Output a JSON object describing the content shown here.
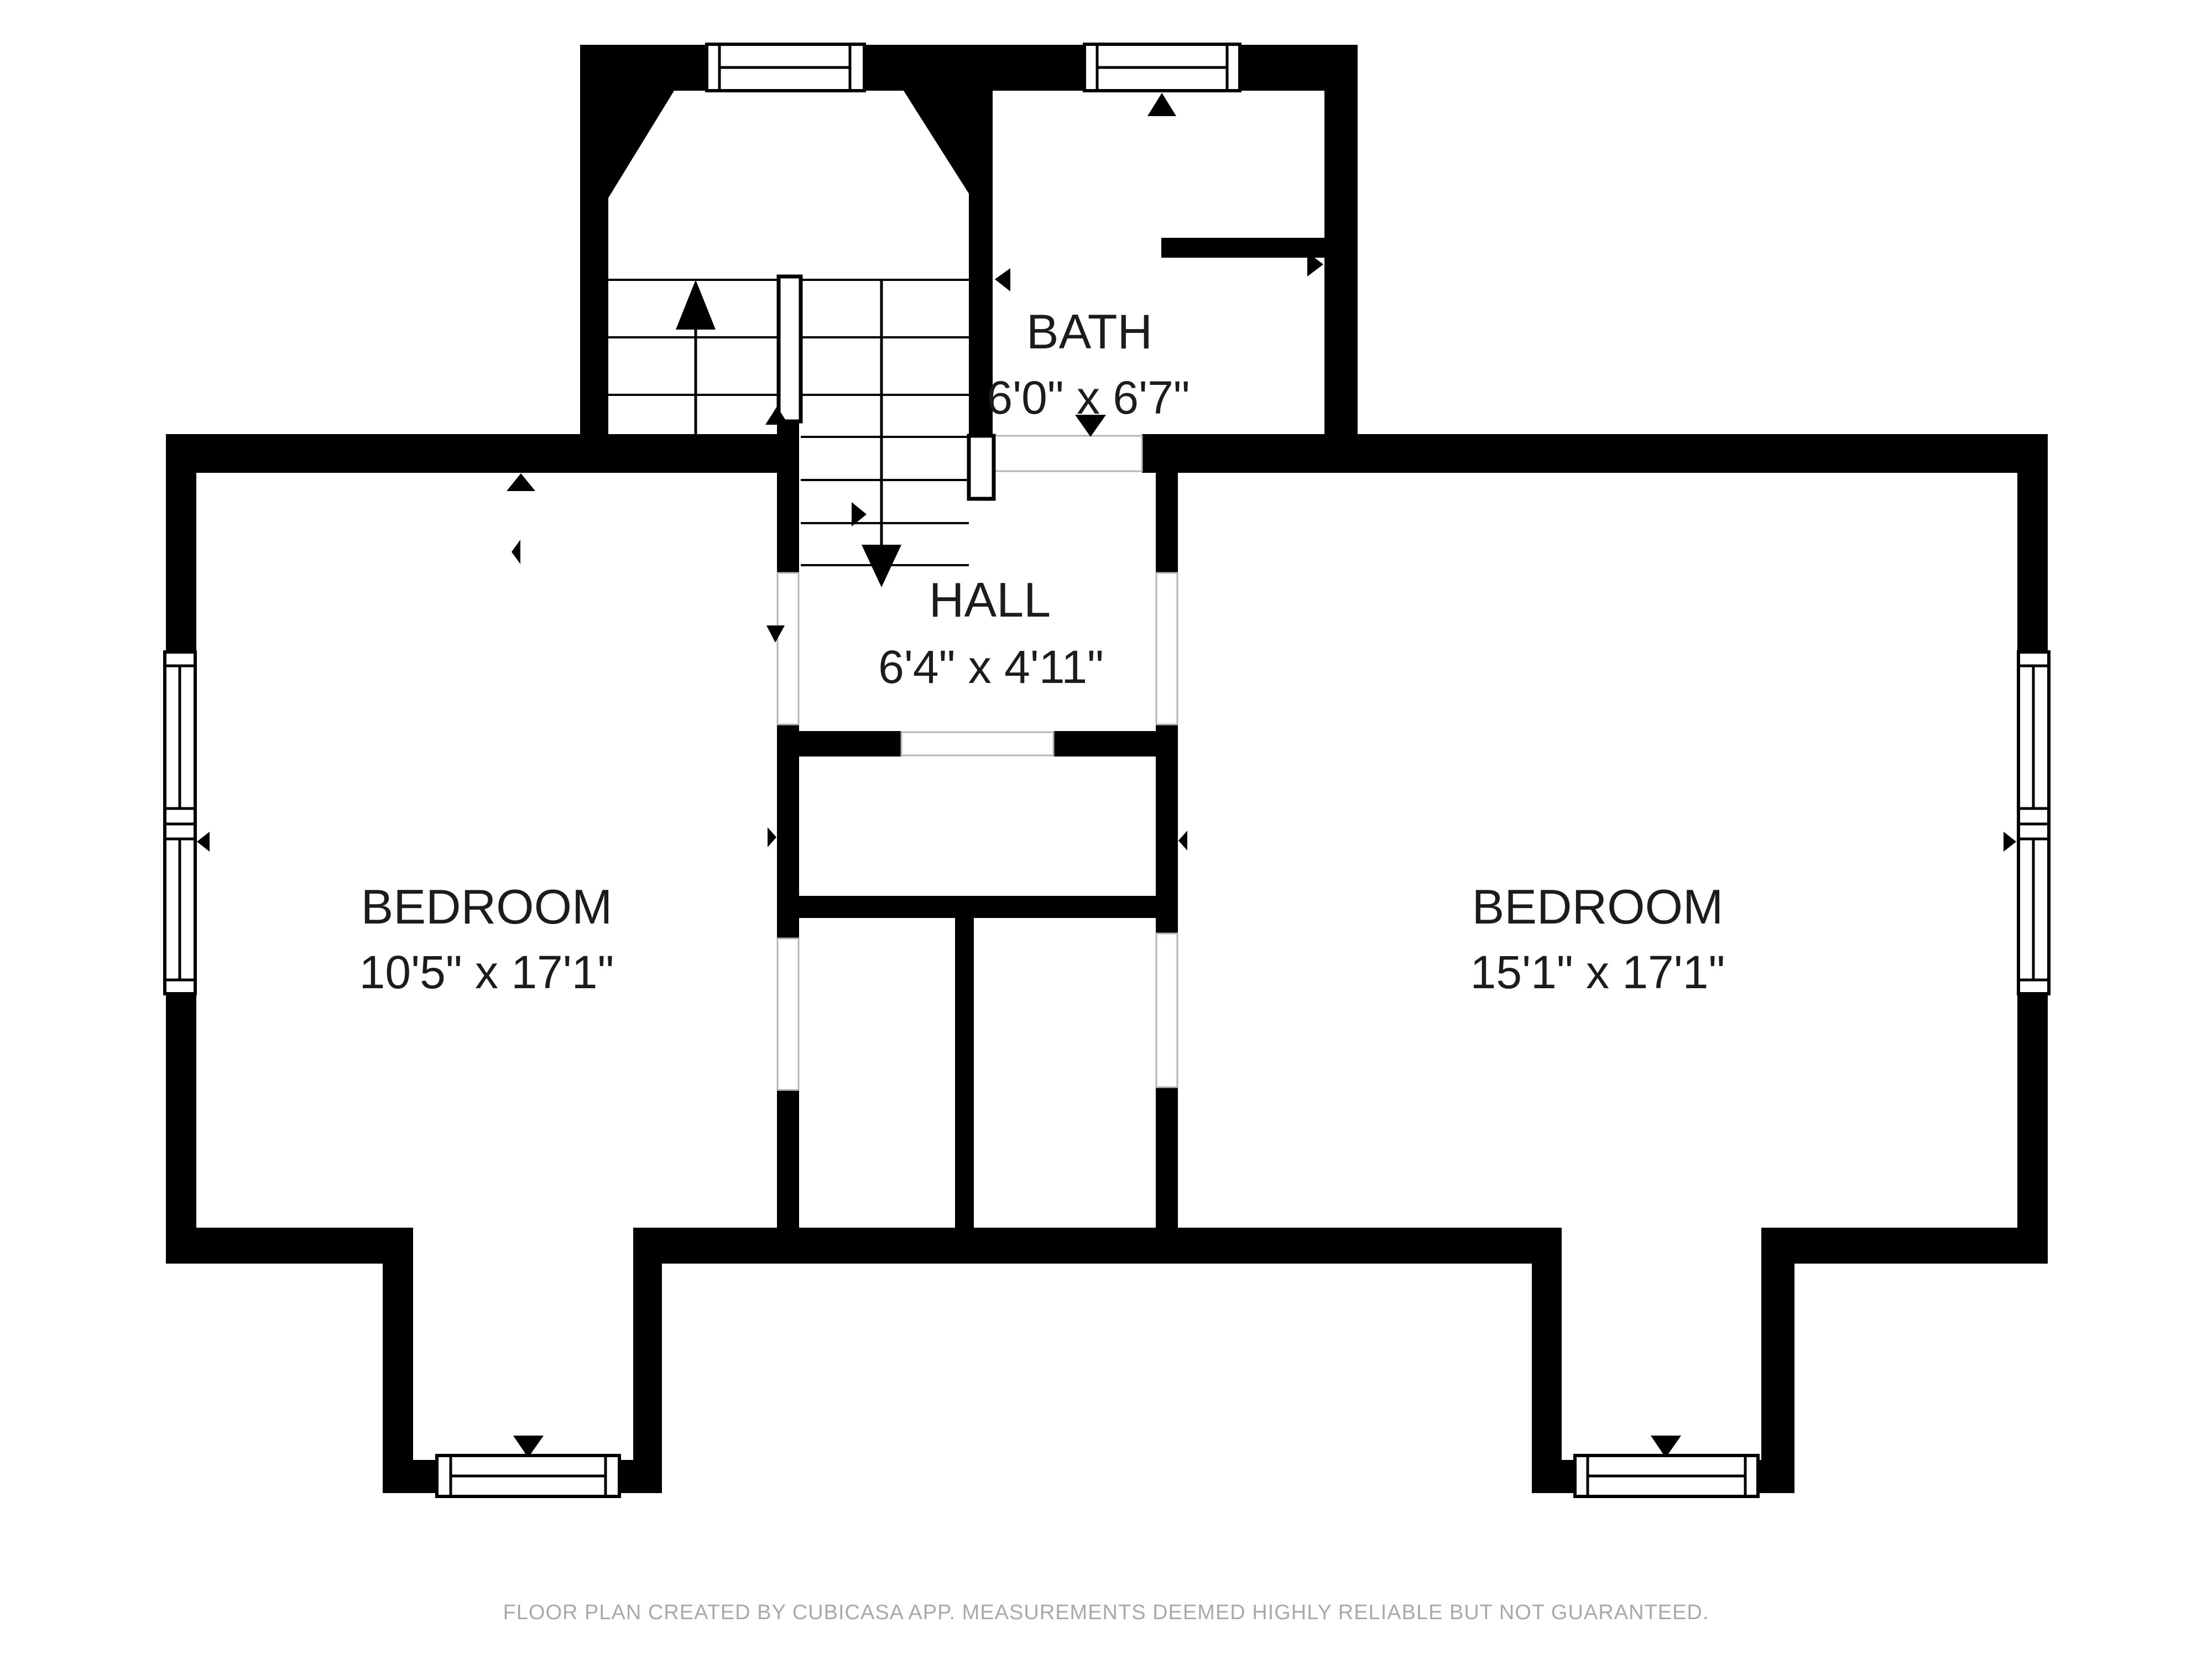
{
  "rooms": {
    "bath": {
      "name": "BATH",
      "dims": "6'0\" x 6'7\""
    },
    "hall": {
      "name": "HALL",
      "dims": "6'4\" x 4'11\""
    },
    "bedroom_left": {
      "name": "BEDROOM",
      "dims": "10'5\" x 17'1\""
    },
    "bedroom_right": {
      "name": "BEDROOM",
      "dims": "15'1\" x 17'1\""
    }
  },
  "footer": {
    "disclaimer": "FLOOR PLAN CREATED BY CUBICASA APP. MEASUREMENTS DEEMED HIGHLY RELIABLE BUT NOT GUARANTEED."
  },
  "colors": {
    "wall": "#000000",
    "background": "#ffffff",
    "label_text": "#1c1c1c",
    "footer_text": "#a9a9a9",
    "opening_outline": "#b5b5b5"
  }
}
